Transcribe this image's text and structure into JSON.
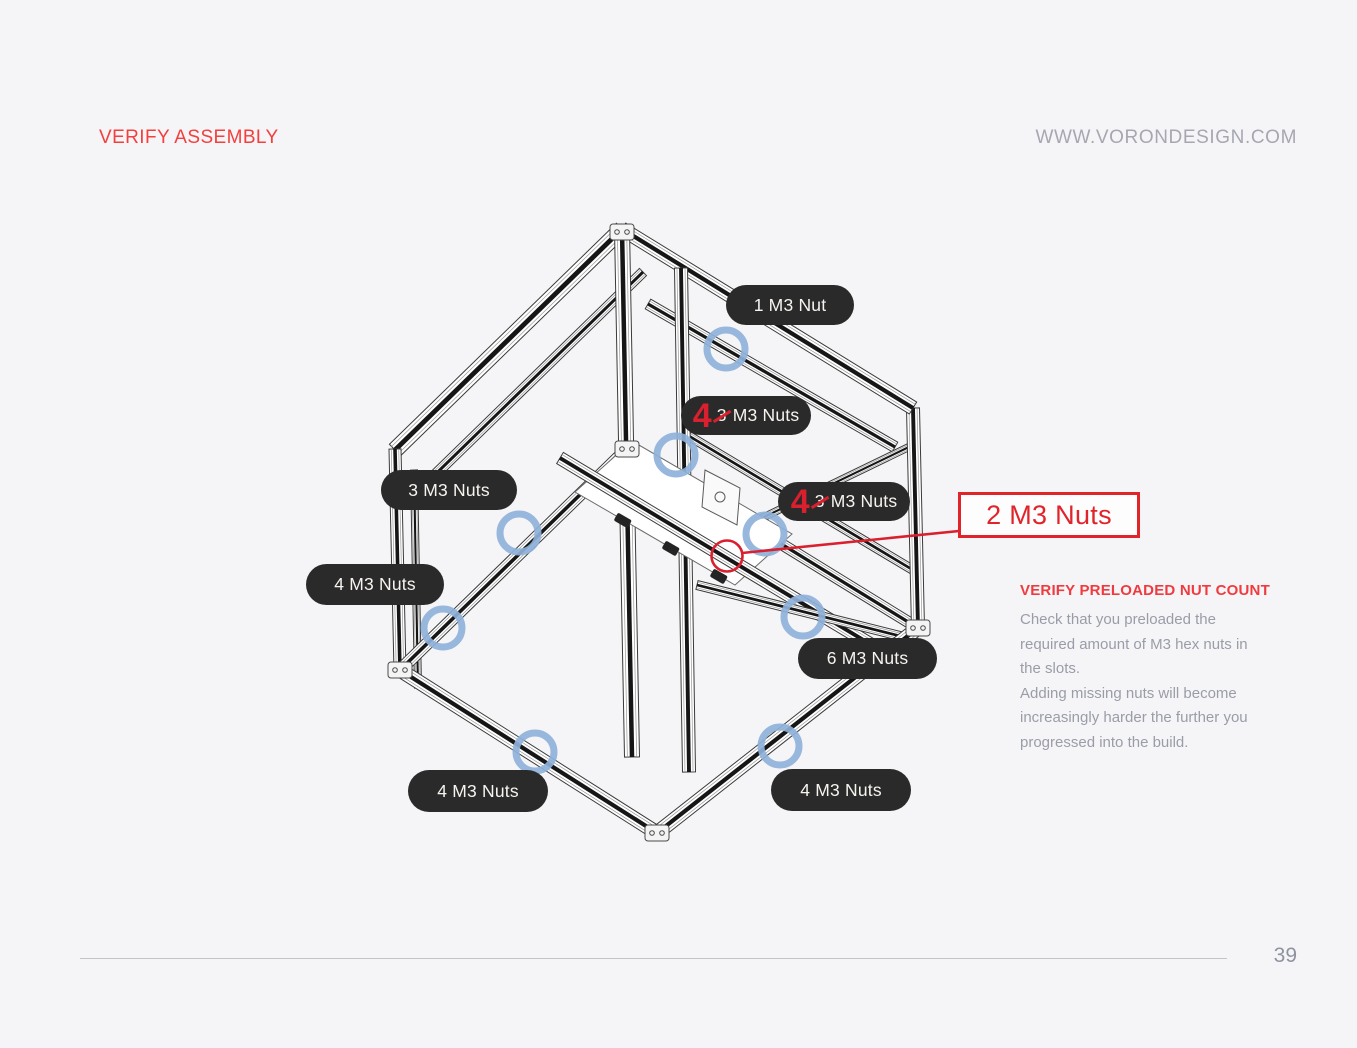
{
  "page": {
    "header_left": "VERIFY ASSEMBLY",
    "header_right": "WWW.VORONDESIGN.COM",
    "page_number": "39"
  },
  "labels": {
    "nut1": {
      "text": "1 M3 Nut"
    },
    "nuts3": {
      "text": "3 M3 Nuts"
    },
    "nuts4_left": {
      "text": "4 M3 Nuts"
    },
    "nuts6": {
      "text": "6 M3 Nuts"
    },
    "nuts4_bottom_left": {
      "text": "4 M3 Nuts"
    },
    "nuts4_bottom_right": {
      "text": "4 M3 Nuts"
    },
    "corrected_top": {
      "new_count": "4",
      "old_count": "3",
      "suffix": "M3 Nuts"
    },
    "corrected_right": {
      "new_count": "4",
      "old_count": "3",
      "suffix": "M3 Nuts"
    },
    "callout_box": {
      "text": "2 M3 Nuts"
    }
  },
  "note": {
    "title": "VERIFY PRELOADED NUT COUNT",
    "lines": [
      "Check that you preloaded the",
      "required amount of M3 hex nuts in",
      "the slots.",
      "Adding missing nuts will become",
      "increasingly harder the further you",
      "progressed into the build."
    ]
  },
  "colors": {
    "page_background": "#f5f5f7",
    "header_red": "#f2403e",
    "correction_red": "#da1f2e",
    "callout_red": "#e02429",
    "pill_background": "#2b2a2a",
    "pill_text": "#f7f4ef",
    "nut_marker_blue": "#8fb1da",
    "body_gray": "#9a9da8",
    "website_gray": "#a7a7b2"
  }
}
